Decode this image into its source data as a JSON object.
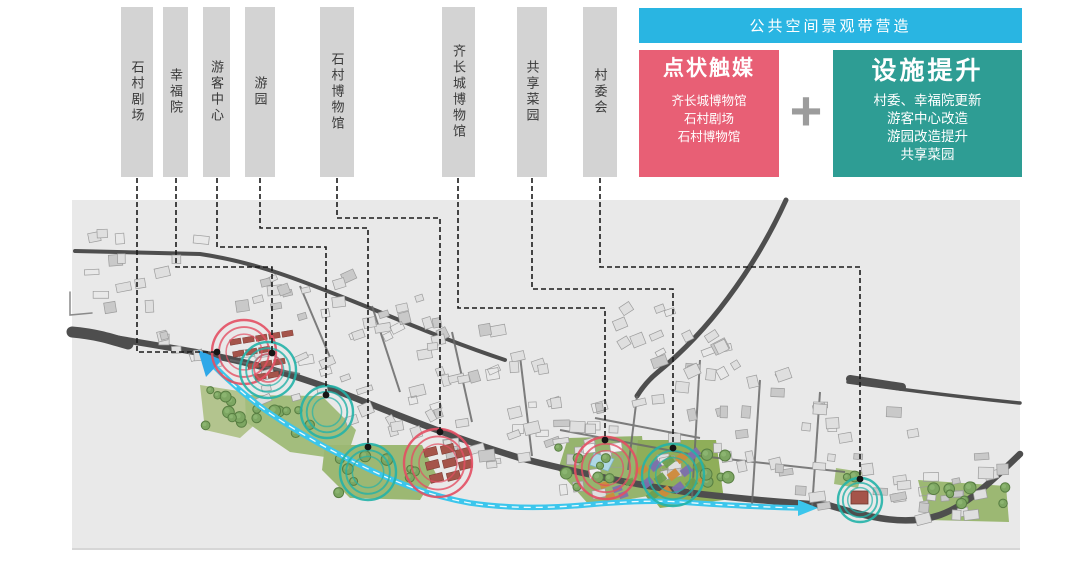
{
  "banner": {
    "text": "公共空间景观带营造",
    "bg": "#29b5e2"
  },
  "point_box": {
    "title": "点状触媒",
    "items": [
      "齐长城博物馆",
      "石村剧场",
      "石村博物馆"
    ],
    "bg": "#e85f75"
  },
  "plus_sign": "+",
  "facility_box": {
    "title": "设施提升",
    "items": [
      "村委、幸福院更新",
      "游客中心改造",
      "游园改造提升",
      "共享菜园"
    ],
    "bg": "#2e9d94"
  },
  "map": {
    "colors": {
      "map_bg": "#e9e9e9",
      "label_bar_bg": "#d3d3d3",
      "red_marker": "#e34f63",
      "teal_marker": "#23b2a8",
      "stream": "#3bc6ec",
      "road": "#4e4e4e"
    },
    "annotations": [
      {
        "id": "shicun-theater",
        "text": "石村剧场",
        "marker_type": "red",
        "leader": [
          [
            137,
            178
          ],
          [
            137,
            352
          ],
          [
            217,
            352
          ]
        ],
        "marker": {
          "x": 244,
          "y": 352,
          "r": 32
        }
      },
      {
        "id": "xingfu-home",
        "text": "幸福院",
        "marker_type": "teal",
        "leader": [
          [
            176,
            178
          ],
          [
            176,
            267
          ],
          [
            272,
            267
          ],
          [
            272,
            353
          ]
        ],
        "marker": {
          "x": 268,
          "y": 370,
          "r": 28
        }
      },
      {
        "id": "visitor-center",
        "text": "游客中心",
        "marker_type": "teal",
        "leader": [
          [
            217,
            178
          ],
          [
            217,
            247
          ],
          [
            326,
            247
          ],
          [
            326,
            395
          ]
        ],
        "marker": {
          "x": 327,
          "y": 412,
          "r": 26
        }
      },
      {
        "id": "garden-park",
        "text": "游园",
        "marker_type": "teal",
        "leader": [
          [
            260,
            178
          ],
          [
            260,
            228
          ],
          [
            368,
            228
          ],
          [
            368,
            447
          ]
        ],
        "marker": {
          "x": 368,
          "y": 472,
          "r": 28
        }
      },
      {
        "id": "shicun-museum",
        "text": "石村博物馆",
        "marker_type": "red",
        "leader": [
          [
            337,
            178
          ],
          [
            337,
            218
          ],
          [
            440,
            218
          ],
          [
            440,
            432
          ]
        ],
        "marker": {
          "x": 438,
          "y": 463,
          "r": 34
        }
      },
      {
        "id": "qi-wall-museum",
        "text": "齐长城博物馆",
        "marker_type": "red",
        "leader": [
          [
            458,
            178
          ],
          [
            458,
            308
          ],
          [
            605,
            308
          ],
          [
            605,
            440
          ]
        ],
        "marker": {
          "x": 606,
          "y": 468,
          "r": 31
        }
      },
      {
        "id": "shared-veg-garden",
        "text": "共享菜园",
        "marker_type": "teal",
        "leader": [
          [
            532,
            178
          ],
          [
            532,
            289
          ],
          [
            673,
            289
          ],
          [
            673,
            448
          ]
        ],
        "marker": {
          "x": 673,
          "y": 475,
          "r": 31
        }
      },
      {
        "id": "village-committee",
        "text": "村委会",
        "marker_type": "teal",
        "leader": [
          [
            600,
            178
          ],
          [
            600,
            267
          ],
          [
            860,
            267
          ],
          [
            860,
            479
          ]
        ],
        "marker": {
          "x": 860,
          "y": 500,
          "r": 22
        }
      }
    ]
  }
}
